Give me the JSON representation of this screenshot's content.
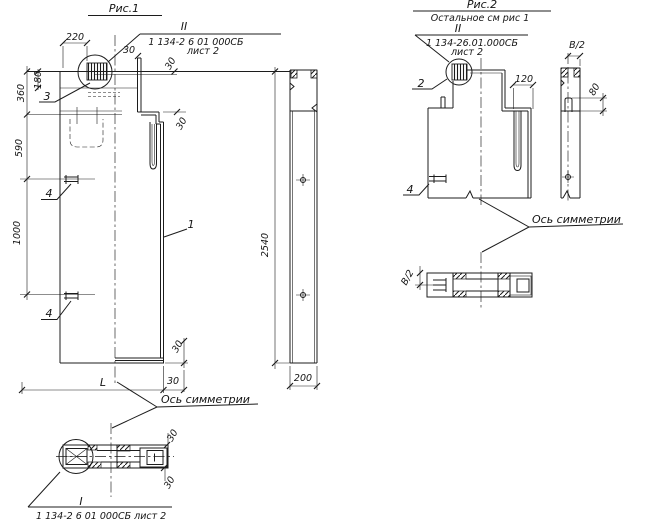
{
  "figure1": {
    "title": "Рис.1",
    "detail_callout": {
      "label": "II",
      "doc": "1 134-2 6 01 000СБ",
      "sheet": "лист 2"
    },
    "dims": {
      "w220": "220",
      "h180": "180",
      "h360": "360",
      "h590": "590",
      "h1000": "1000",
      "t30_top": "30",
      "t30_right": "30",
      "t30_step": "30",
      "t30_bottom_v": "30",
      "t30_bottom_h": "30",
      "length_L": "L",
      "bar_h2540": "2540",
      "bar_w200": "200"
    },
    "part_labels": {
      "p1": "1",
      "p3": "3",
      "p4_upper": "4",
      "p4_lower": "4"
    },
    "axis_text": "Ось симметрии",
    "section": {
      "label": "I",
      "caption": "1 134-2 6 01 000СБ лист 2",
      "t30_top": "30",
      "t30_bottom": "30"
    }
  },
  "figure2": {
    "title": "Рис.2",
    "subtitle": "Остальное см рис 1",
    "detail_callout": {
      "label": "II",
      "doc": "1 134-26.01.000СБ",
      "sheet": "лист 2"
    },
    "dims": {
      "w120": "120",
      "b2_top": "В/2",
      "h80": "80",
      "b2_section": "В/2"
    },
    "part_labels": {
      "p2": "2",
      "p4": "4"
    },
    "axis_text": "Ось симметрии"
  }
}
